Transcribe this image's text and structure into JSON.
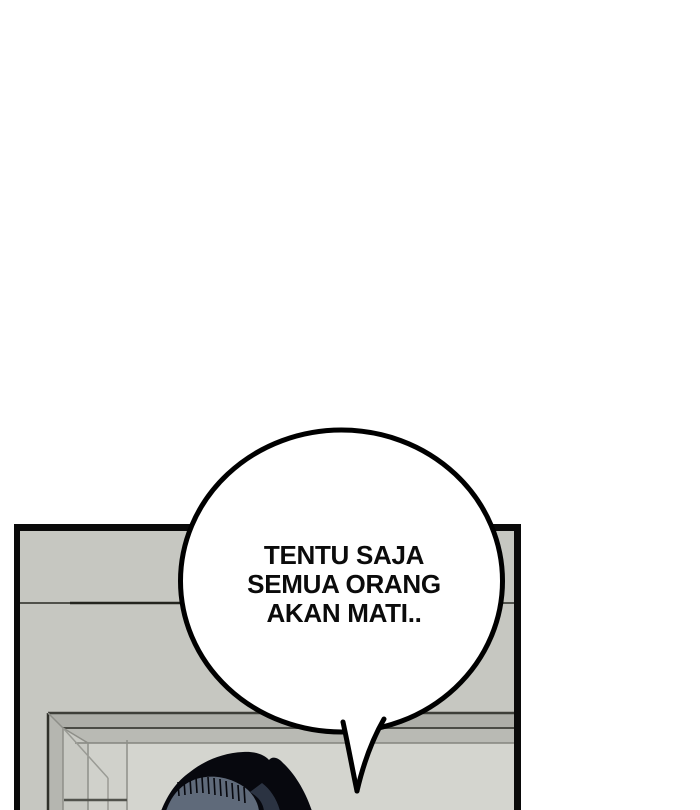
{
  "speech_bubble": {
    "lines": [
      "TENTU SAJA",
      "SEMUA ORANG",
      "AKAN MATI.."
    ],
    "full_text": "TENTU SAJA SEMUA ORANG AKAN MATI..",
    "fill": "#ffffff",
    "stroke": "#000000",
    "text_color": "#0b0b0b"
  },
  "colors": {
    "page_background": "#ffffff",
    "ink": "#000000",
    "panel_border": "#0a0a0a",
    "wall": "#c6c7c1",
    "wall_seam": "#50514b",
    "wall_seam_dark": "#23241e",
    "lintel_band_upper": "#adaea8",
    "lintel_band_lower": "#b9bab4",
    "lintel_line_dark": "#3d3e38",
    "lintel_line_mid": "#4a4b45",
    "lintel_line_light": "#84857f",
    "jamb_outer_face": "#b5b6b0",
    "jamb_face": "#c9cac4",
    "jamb_inner_face": "#d0d1cb",
    "doorway_interior": "#d4d5cf",
    "frame_line": "#8e8f89",
    "frame_line_light": "#9a9b95",
    "frame_dark_edge": "#2f302a",
    "frame_bottom_shadow": "#51524c",
    "hair_black": "#07080e",
    "hair_bangs_slate": "#5f6a7a",
    "hair_sheen_navy": "#2b3342"
  }
}
